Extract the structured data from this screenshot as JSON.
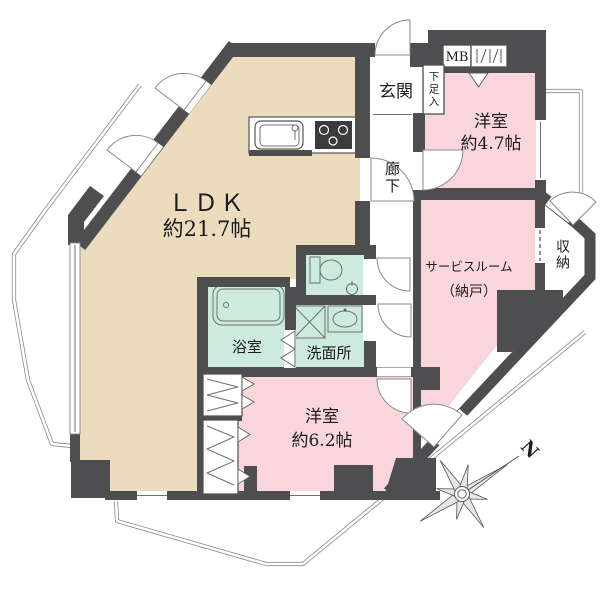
{
  "rooms": {
    "ldk": {
      "label": "ＬＤＫ",
      "size": "約21.7帖"
    },
    "entrance": {
      "label": "玄関"
    },
    "shoe_storage": {
      "label": "下足入"
    },
    "meter_box": {
      "label": "MB"
    },
    "corridor": {
      "label": "廊下"
    },
    "bedroom_47": {
      "label": "洋室",
      "size": "約4.7帖"
    },
    "service_room": {
      "label": "サービスルーム",
      "sublabel": "（納戸）"
    },
    "storage": {
      "label": "収納"
    },
    "bathroom": {
      "label": "浴室"
    },
    "washroom": {
      "label": "洗面所"
    },
    "bedroom_62": {
      "label": "洋室",
      "size": "約6.2帖"
    }
  },
  "compass": {
    "label": "N"
  },
  "colors": {
    "wall": "#4e4e50",
    "ldk_floor": "#EBDCBD",
    "bedroom_floor": "#F8D6DC",
    "wet_area_floor": "#CCEBDE",
    "balcony_line": "#8a8a8a"
  }
}
